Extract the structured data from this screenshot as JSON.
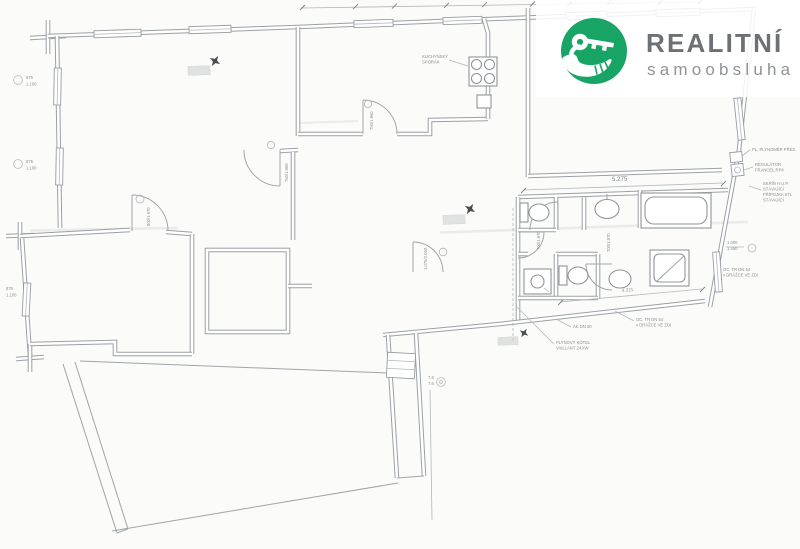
{
  "logo": {
    "brand": "REALITNÍ",
    "tagline": "samoobsluha",
    "brand_color": "#18a464",
    "brand_text_color": "#6d7174",
    "tagline_text_color": "#8f9396",
    "icon": "hand-holding-key-icon"
  },
  "plan": {
    "labels": {
      "kitchen_stove_1": "KUCHYŇSKÝ",
      "kitchen_stove_2": "SPORÁK",
      "boiler_1": "PLYNOVÝ KOTEL",
      "boiler_2": "VAILLANT 24 kW",
      "ak": "AK DN 50",
      "oc1": "OC. TR DN 54",
      "oc2": "v DRÁŽCE VE ZDI",
      "plynomer": "PL. PLYNOMĚR PŘES.",
      "reg1": "REGULÁTOR",
      "reg2": "FRANCEL RP4",
      "hup1": "SKŘÍŇ H.U.P.",
      "hup2": "STÁVAJÍCÍ",
      "hup3": "PŘÍPOJKA STL",
      "hup4": "STÁVAJÍCÍ"
    },
    "dims": {
      "bath_top": "5.275",
      "bath_bottom": "4.221",
      "right_a": "1.000",
      "right_b": "1.450",
      "win_a": "875",
      "win_b": "1.100",
      "strip_a": "7.5",
      "strip_b": "7.6",
      "door_living": "750/1.960",
      "door_room": "800/1.970",
      "door_kitchen": "750/1.960",
      "door_closet": "1.075/2.060",
      "door_wc": "700/1.970"
    },
    "line_color": "#9ba0a4"
  }
}
